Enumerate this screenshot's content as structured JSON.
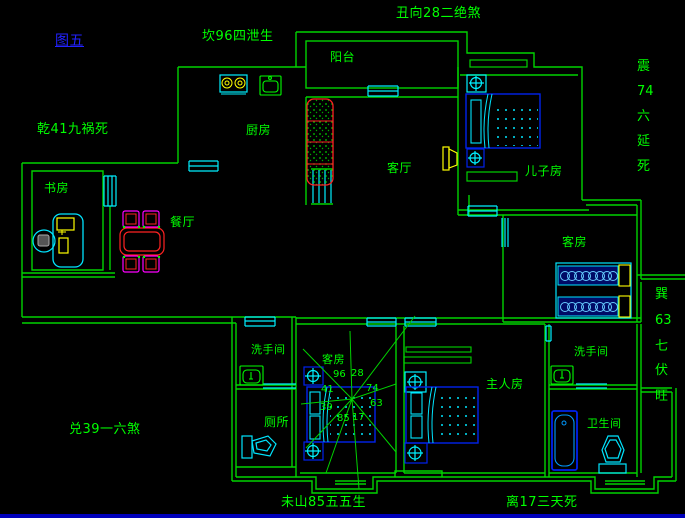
{
  "fengshui": {
    "figure_label": "图五",
    "top": "丑向28二绝煞",
    "top_left": "坎96四泄生",
    "left_upper": "乾41九祸死",
    "left_lower": "兑39一六煞",
    "bottom_left": "未山85五五生",
    "bottom_right": "离17三天死",
    "right_upper": [
      "震",
      "74",
      "六",
      "延",
      "死"
    ],
    "right_lower": [
      "巽",
      "63",
      "七",
      "伏",
      "旺"
    ]
  },
  "rooms": {
    "balcony": "阳台",
    "kitchen": "厨房",
    "study": "书房",
    "dining": "餐厅",
    "living": "客厅",
    "sons_room": "儿子房",
    "guest_room_right": "客房",
    "guest_room_center": "客房",
    "washroom_left": "洗手间",
    "toilet": "厕所",
    "master_room": "主人房",
    "washroom_right": "洗手间",
    "bathroom": "卫生间"
  },
  "compass": {
    "numbers": [
      "96",
      "28",
      "41",
      "74",
      "39",
      "63",
      "85",
      "17"
    ]
  },
  "colors": {
    "wall_green": "#00d200",
    "text_green": "#00ff00",
    "window_cyan": "#00f0ff",
    "furniture_blue": "#0022ee",
    "sofa_red": "#ff2222",
    "accent_yellow": "#ffff00",
    "chair_magenta": "#ff00ff",
    "figure_blue": "#2222ff",
    "bottom_bar_blue": "#0000bb"
  }
}
